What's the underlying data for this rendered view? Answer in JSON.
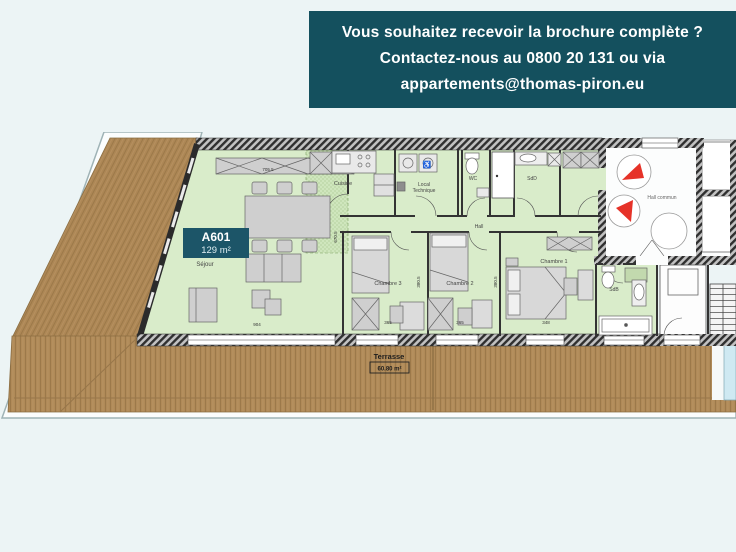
{
  "banner": {
    "line1": "Vous souhaitez recevoir la brochure complète ?",
    "line2": "Contactez-nous au 0800 20 131 ou via",
    "line3": "appartements@thomas-piron.eu"
  },
  "badge": {
    "unit": "A601",
    "area": "129 m²"
  },
  "labels": {
    "sejour": "Séjour",
    "cuisine": "Cuisine",
    "local_l1": "Local",
    "local_l2": "Technique",
    "wc": "WC",
    "sdd": "SdD",
    "hall": "Hall",
    "chambre1": "Chambre 1",
    "chambre2": "Chambre 2",
    "chambre3": "Chambre 3",
    "sdb": "SdB",
    "hall_commun": "Hall commun",
    "terrasse": "Terrasse",
    "terrasse_area": "60.80 m²",
    "accessible_icon": "♿"
  },
  "dimensions": {
    "top_width": "705.5",
    "left_height": "670.5",
    "sejour_width": "904",
    "chambre3_width": "365",
    "chambre2_width": "365",
    "chambre1_width": "348",
    "chambre3_height": "380.5",
    "chambre1_height": "380.5"
  },
  "colors": {
    "banner_bg": "#14505e",
    "apartment_fill": "#d9ecca",
    "wood": "#b08a58",
    "badge_bg": "#1c5568",
    "arrow_red": "#e63228"
  }
}
